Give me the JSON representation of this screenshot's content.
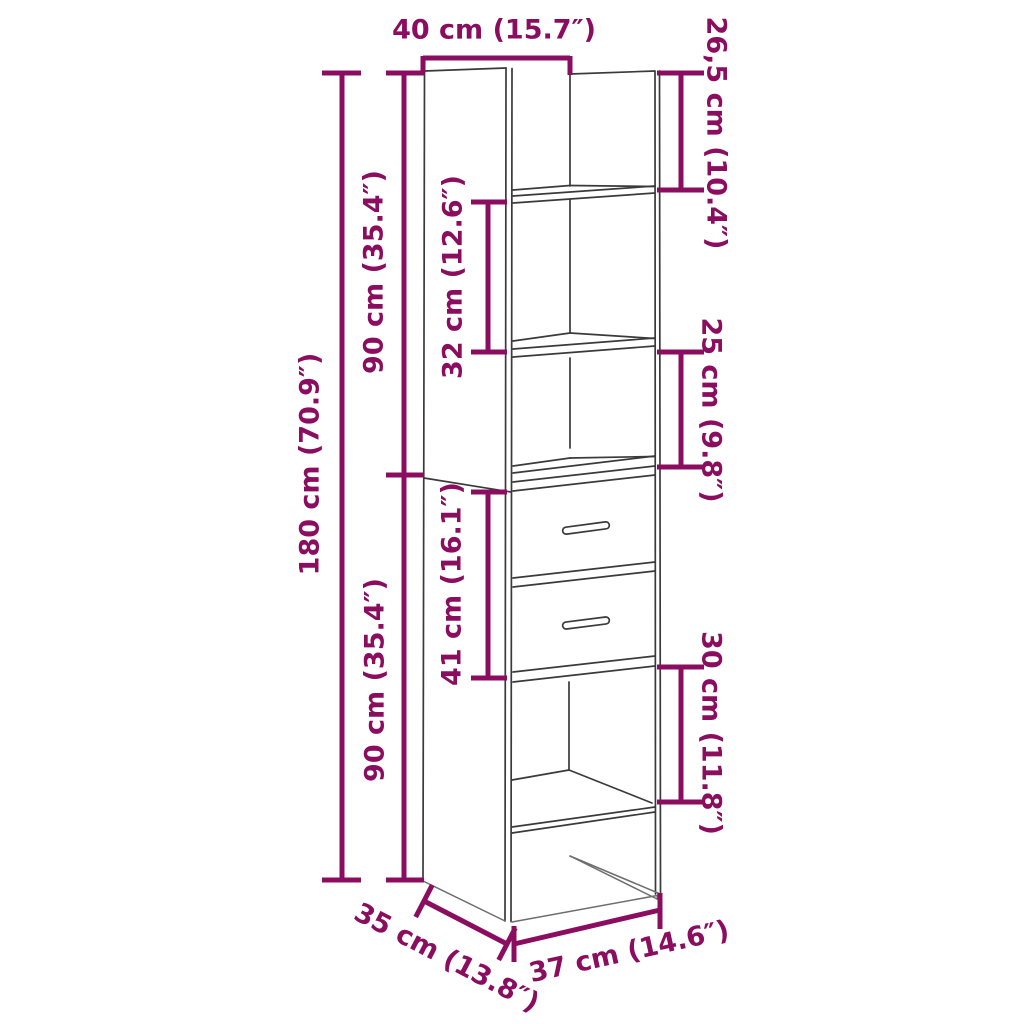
{
  "diagram": {
    "subject": "tall-cabinet-with-two-drawers-dimension-diagram",
    "units": "cm and inches",
    "colors": {
      "dimension_accent": "#8B0D60",
      "outline": "#3A3A3A",
      "background": "#FFFFFF"
    },
    "labels": {
      "top_width": "40 cm (15.7″)",
      "top_compartment_height": "26,5 cm (10.4″)",
      "upper_section_height": "90 cm (35.4″)",
      "shelf_gap_height": "32 cm (12.6″)",
      "third_compartment_height": "25 cm (9.8″)",
      "total_height": "180 cm (70.9″)",
      "drawer_section_height": "41 cm (16.1″)",
      "lower_section_height": "90 cm (35.4″)",
      "bottom_compartment_height": "30 cm (11.8″)",
      "depth": "35 cm (13.8″)",
      "bottom_width": "37 cm (14.6″)"
    }
  }
}
